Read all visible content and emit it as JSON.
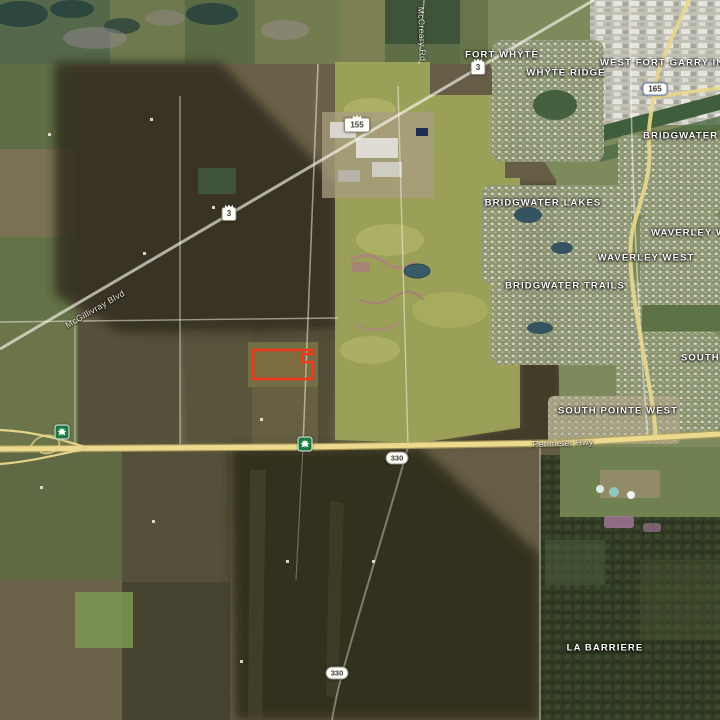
{
  "map": {
    "view_type": "satellite",
    "place_labels": {
      "fort_whyte": "FORT WHYTE",
      "whyte_ridge": "WHYTE RIDGE",
      "west_fort_garry_industrial": "WEST FORT GARRY INDUSTRIAL",
      "bridgwater_forest": "BRIDGWATER FOREST",
      "bridgwater_lakes": "BRIDGWATER LAKES",
      "waverley_west_right": "WAVERLEY WEST",
      "waverley_west": "WAVERLEY WEST",
      "bridgwater_trails": "BRIDGWATER TRAILS",
      "south_pointe": "SOUTH POINTE",
      "south_pointe_west": "SOUTH POINTE WEST",
      "la_barriere": "LA BARRIERE"
    },
    "road_labels": {
      "mcgillivray_blvd": "McGillivray Blvd",
      "mccreary_rd": "McCreary Rd",
      "perimeter_hwy": "Perimeter Hwy"
    },
    "route_shields": {
      "pth3_north": "3",
      "pr155": "155",
      "pth3_south": "3",
      "route165": "165",
      "pr330_north": "330",
      "pr330_south": "330"
    },
    "icons": {
      "tch_shield": "maple-leaf-icon",
      "crown": "crown-icon"
    },
    "parcel": {
      "points": "253,350 313,350 313,354 302,354 302,362 313,362 313,379 253,379",
      "stroke": "#f2371b"
    },
    "colors": {
      "highlight_red": "#f2371b",
      "highway_yellow": "#ecda8e",
      "tch_green": "#1c7a40"
    }
  }
}
